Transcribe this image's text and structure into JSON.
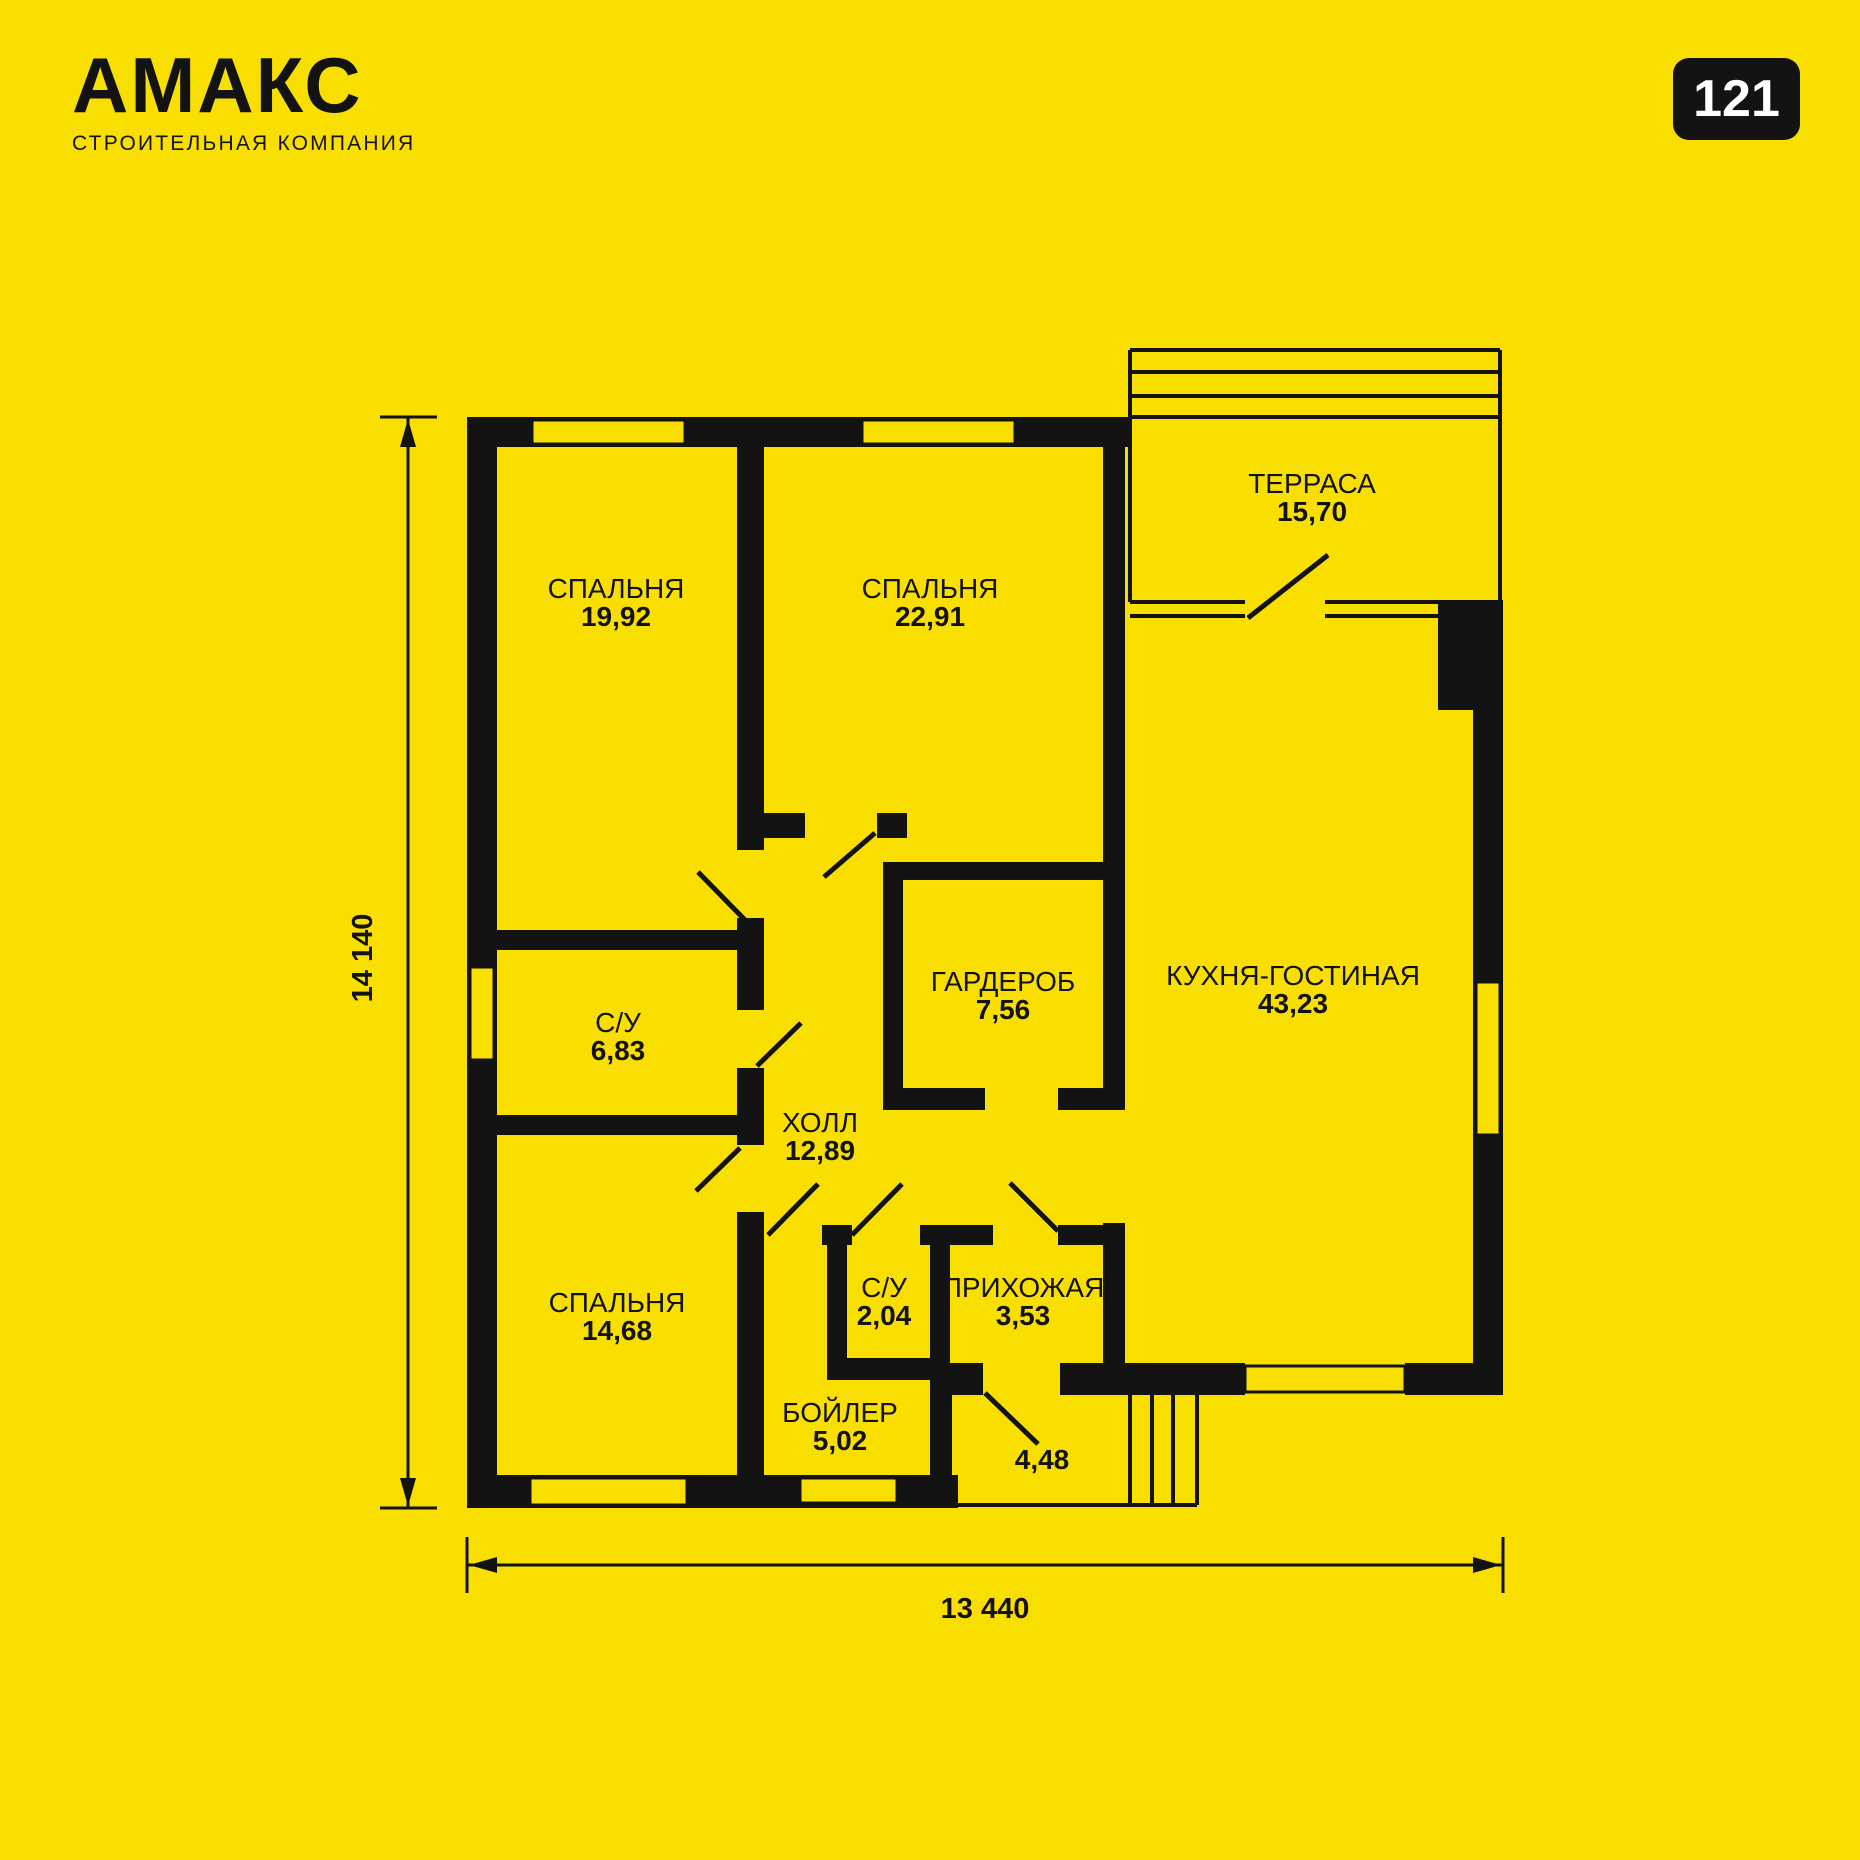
{
  "brand": {
    "name": "АМАКС",
    "tagline": "СТРОИТЕЛЬНАЯ КОМПАНИЯ"
  },
  "badge": {
    "number": "121"
  },
  "plan": {
    "dimensions": {
      "height_label": "14 140",
      "width_label": "13 440"
    },
    "rooms": [
      {
        "id": "bedroom-1",
        "name": "СПАЛЬНЯ",
        "area": "19,92",
        "cx": 616,
        "cy": 588
      },
      {
        "id": "bedroom-2",
        "name": "СПАЛЬНЯ",
        "area": "22,91",
        "cx": 930,
        "cy": 588
      },
      {
        "id": "terrace",
        "name": "ТЕРРАСА",
        "area": "15,70",
        "cx": 1312,
        "cy": 483
      },
      {
        "id": "kitchen-living",
        "name": "КУХНЯ-ГОСТИНАЯ",
        "area": "43,23",
        "cx": 1293,
        "cy": 975
      },
      {
        "id": "wardrobe",
        "name": "ГАРДЕРОБ",
        "area": "7,56",
        "cx": 1003,
        "cy": 981
      },
      {
        "id": "bathroom-1",
        "name": "С/У",
        "area": "6,83",
        "cx": 618,
        "cy": 1022
      },
      {
        "id": "hall",
        "name": "ХОЛЛ",
        "area": "12,89",
        "cx": 820,
        "cy": 1122
      },
      {
        "id": "bedroom-3",
        "name": "СПАЛЬНЯ",
        "area": "14,68",
        "cx": 617,
        "cy": 1302
      },
      {
        "id": "bathroom-2",
        "name": "С/У",
        "area": "2,04",
        "cx": 884,
        "cy": 1287
      },
      {
        "id": "entry-hall",
        "name": "ПРИХОЖАЯ",
        "area": "3,53",
        "cx": 1023,
        "cy": 1287
      },
      {
        "id": "boiler",
        "name": "БОЙЛЕР",
        "area": "5,02",
        "cx": 840,
        "cy": 1412
      },
      {
        "id": "porch",
        "name": "",
        "area": "4,48",
        "cx": 1042,
        "cy": 1459
      }
    ]
  },
  "colors": {
    "background": "#F9DF00",
    "ink": "#131313",
    "badge_bg": "#131313",
    "badge_text": "#FFFFFF"
  }
}
